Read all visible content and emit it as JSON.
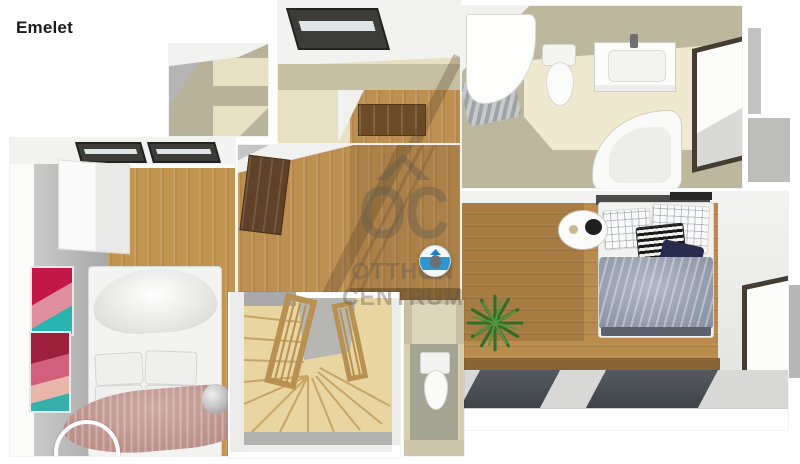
{
  "page": {
    "title": "Emelet"
  },
  "watermark": {
    "logo_text": "OC",
    "line1": "OTTHON",
    "line2": "CENTRUM"
  },
  "floorplan": {
    "view": "top-down-3d-render",
    "rooms": [
      {
        "name": "closet-top",
        "features": [
          "sloped-ceiling",
          "shelving"
        ]
      },
      {
        "name": "hallway-top",
        "features": [
          "skylight-window",
          "wood-landing",
          "wooden-door"
        ]
      },
      {
        "name": "bathroom",
        "features": [
          "shower-cabin",
          "toilet",
          "vanity-sink",
          "corner-bathtub",
          "window"
        ]
      },
      {
        "name": "bedroom-right",
        "features": [
          "double-bed",
          "grid-pillows",
          "chevron-pillow",
          "navy-pillow",
          "side-table",
          "potted-palm",
          "roof-window-panels",
          "wall-window"
        ]
      },
      {
        "name": "bedroom-left",
        "features": [
          "double-bed",
          "white-wardrobe",
          "two-art-frames",
          "pink-blanket",
          "silver-pouf",
          "hanging-ring",
          "roof-skylights"
        ]
      },
      {
        "name": "landing-hall",
        "features": [
          "wood-floor",
          "open-door-leaf",
          "railing-shadow",
          "camera-sphere-marker"
        ]
      },
      {
        "name": "staircase",
        "features": [
          "winder-stairs",
          "spindle-railing"
        ]
      },
      {
        "name": "wc",
        "features": [
          "toilet"
        ]
      }
    ]
  },
  "palette": {
    "background": "#ffffff",
    "title_color": "#1b1b1b",
    "wood_floor": "#bd9052",
    "stair_wood": "#e9d5a0",
    "wall_beige": "#c9c2a4",
    "floor_beige_light": "#efe9cf",
    "wall_gray": "#b2b2b2",
    "ceiling_white": "#f2f2f1",
    "window_frame": "#453d31",
    "skylight_glass": "#3c3c38",
    "duvet_gray": "#97a1b2",
    "pillow_navy": "#272c4f",
    "blanket_pink": "#c2928a",
    "plant_green": "#2f6d28",
    "marker_blue": "#2e96d2",
    "watermark_gray": "rgba(96,89,80,0.40)"
  }
}
